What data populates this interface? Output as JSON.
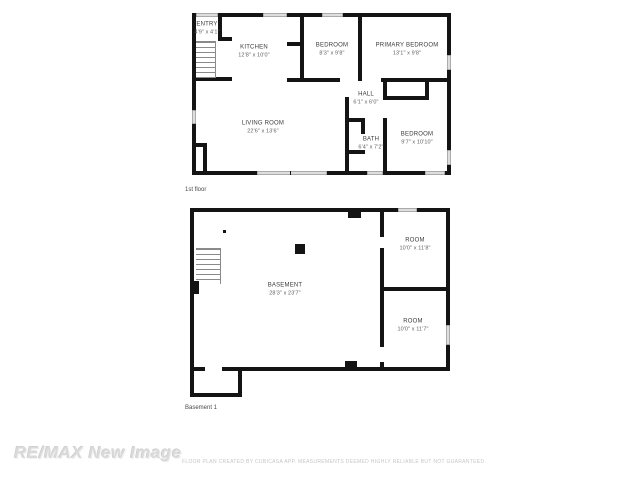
{
  "floors": [
    {
      "caption": "1st floor",
      "rooms": [
        {
          "name": "ENTRY",
          "dims": "4'9\" x 4'1\""
        },
        {
          "name": "KITCHEN",
          "dims": "12'8\" x 10'0\""
        },
        {
          "name": "BEDROOM",
          "dims": "8'3\" x 9'8\""
        },
        {
          "name": "PRIMARY BEDROOM",
          "dims": "13'1\" x 9'8\""
        },
        {
          "name": "HALL",
          "dims": "6'1\" x 6'0\""
        },
        {
          "name": "LIVING ROOM",
          "dims": "22'6\" x 13'6\""
        },
        {
          "name": "BATH",
          "dims": "6'4\" x 7'2\""
        },
        {
          "name": "BEDROOM",
          "dims": "9'7\" x 10'10\""
        }
      ]
    },
    {
      "caption": "Basement 1",
      "rooms": [
        {
          "name": "BASEMENT",
          "dims": "28'3\" x 23'7\""
        },
        {
          "name": "ROOM",
          "dims": "10'0\" x 11'8\""
        },
        {
          "name": "ROOM",
          "dims": "10'0\" x 11'7\""
        }
      ]
    }
  ],
  "watermark": "RE/MAX New Image",
  "disclaimer": "FLOOR PLAN CREATED BY CUBICASA APP. MEASUREMENTS DEEMED HIGHLY RELIABLE BUT NOT GUARANTEED.",
  "colors": {
    "wall": "#141414",
    "window": "#dedede",
    "watermark": "#dadada",
    "disclaimer": "#c6c6c6"
  }
}
